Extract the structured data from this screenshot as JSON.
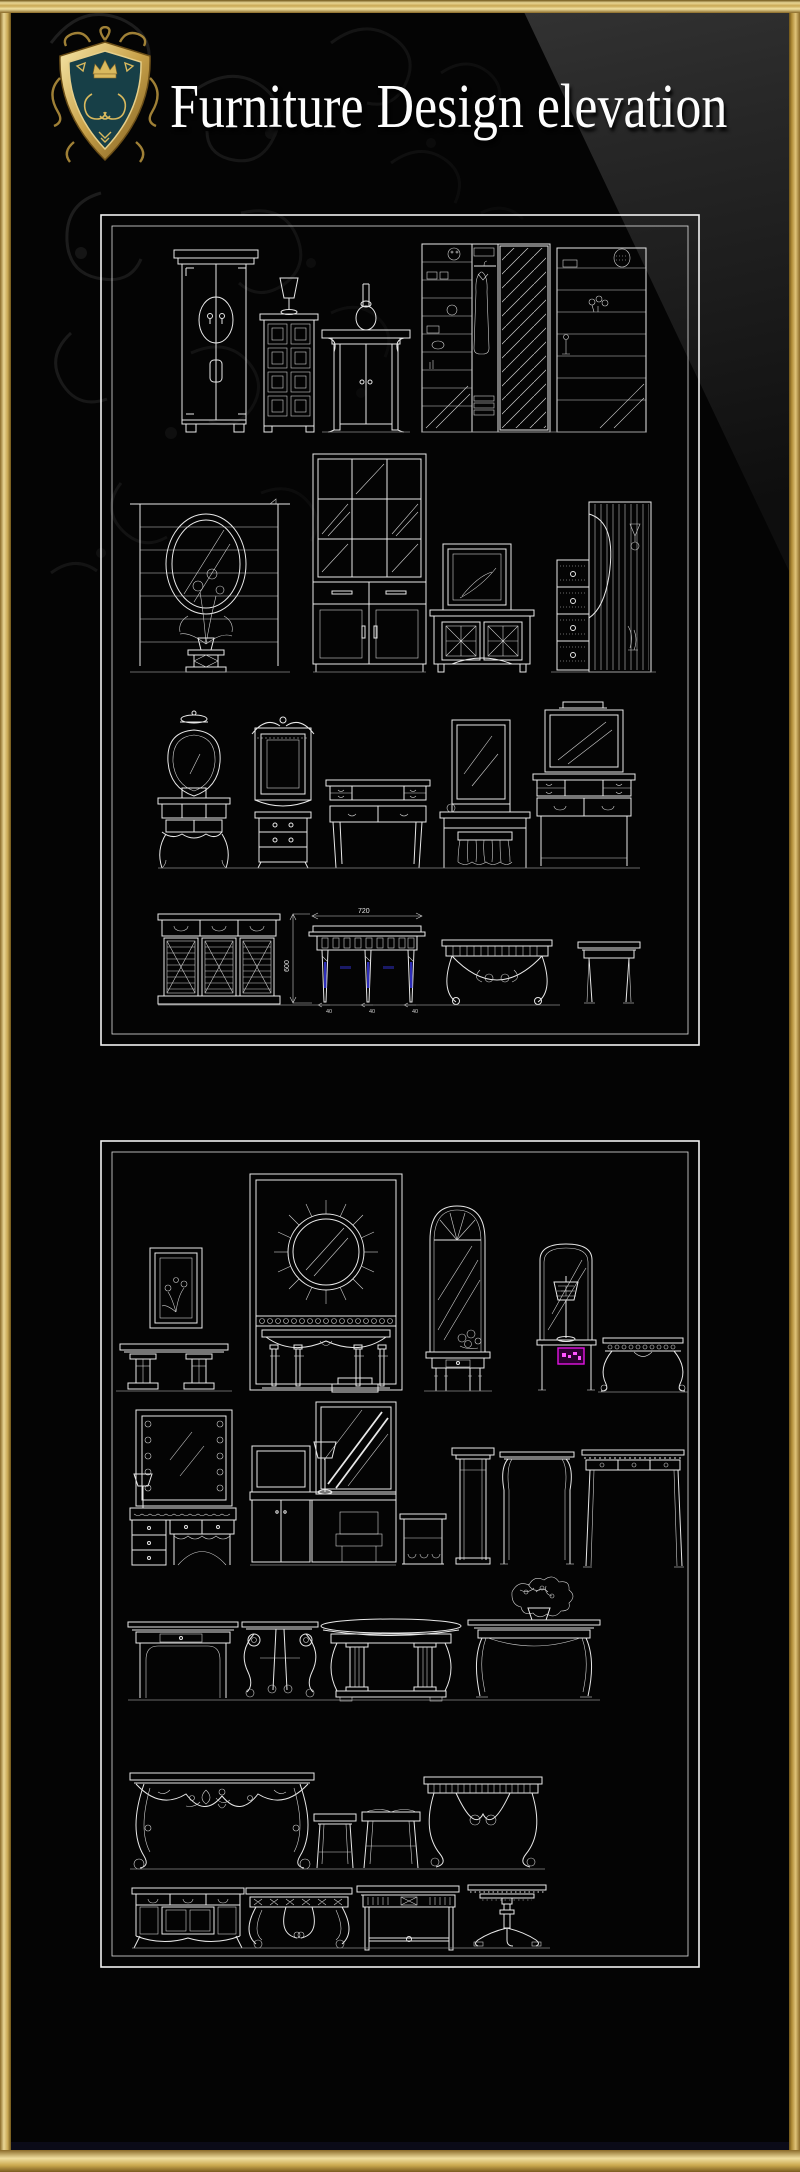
{
  "page": {
    "width": 800,
    "height": 2172,
    "background": "#000000"
  },
  "header": {
    "title": "Furniture Design elevation",
    "logo": "heraldic-crest-shield"
  },
  "colors": {
    "gold_light": "#f0dfa0",
    "gold_mid": "#c9a855",
    "gold_dark": "#6e5418",
    "drawing_line": "#e8e8e8",
    "panel_border": "#f2f2f2",
    "accent_blue": "#2d2db8",
    "accent_magenta": "#e314e3",
    "crest_field_teal": "#173f47",
    "background": "#000000"
  },
  "annotations": {
    "dim_width": "720",
    "dim_height": "600",
    "dim_foot_left": "40",
    "dim_foot_mid": "40",
    "dim_foot_right": "40"
  },
  "watermark": {
    "type": "magenta-label-box",
    "color": "#e314e3"
  },
  "panels": [
    {
      "id": "panel-1",
      "rows": [
        {
          "items": [
            "two-door-wardrobe",
            "chest-of-drawers-with-lamp",
            "altar-side-cabinet-with-vase",
            "wardrobe-closet-with-shelves-clothes-mirror",
            "shelf-unit-with-items"
          ]
        },
        {
          "items": [
            "lined-stand-with-oval-mirror-and-flower-pedestal",
            "glass-display-cabinet",
            "two-door-cabinet-with-leaning-picture",
            "drawer-column-with-curtain-panel"
          ]
        },
        {
          "items": [
            "vanity-with-shield-mirror",
            "pediment-mirror-with-nightstand",
            "writing-desk",
            "dressing-table-with-mirror-and-skirted-stool",
            "dresser-with-lighted-mirror"
          ]
        },
        {
          "items": [
            "louvered-three-door-cabinet",
            "dimensioned-console-table",
            "wrought-iron-console",
            "small-console-table"
          ]
        }
      ]
    },
    {
      "id": "panel-2",
      "rows": [
        {
          "items": [
            "pedestal-console-with-picture",
            "sunburst-mirror-console-panel",
            "arched-mirror-console",
            "mirror-table-with-lamp",
            "scroll-leg-side-table"
          ]
        },
        {
          "items": [
            "hollywood-mirror-vanity",
            "vanity-unit-with-mirror-lamp-and-stool",
            "open-shelf-stand",
            "narrow-pedestal-console",
            "curved-leg-console",
            "long-reeded-console-desk"
          ]
        },
        {
          "items": [
            "console-table-with-drawer",
            "lyre-scroll-table",
            "oval-pedestal-dining-table",
            "table-with-flower-arrangement"
          ]
        },
        {
          "items": [
            "rococo-carved-console",
            "wooden-stool",
            "upholstered-stool",
            "iron-mosaic-console"
          ]
        },
        {
          "items": [
            "three-door-sideboard",
            "rococo-side-table",
            "mission-style-table",
            "round-pedestal-table"
          ]
        }
      ]
    }
  ]
}
